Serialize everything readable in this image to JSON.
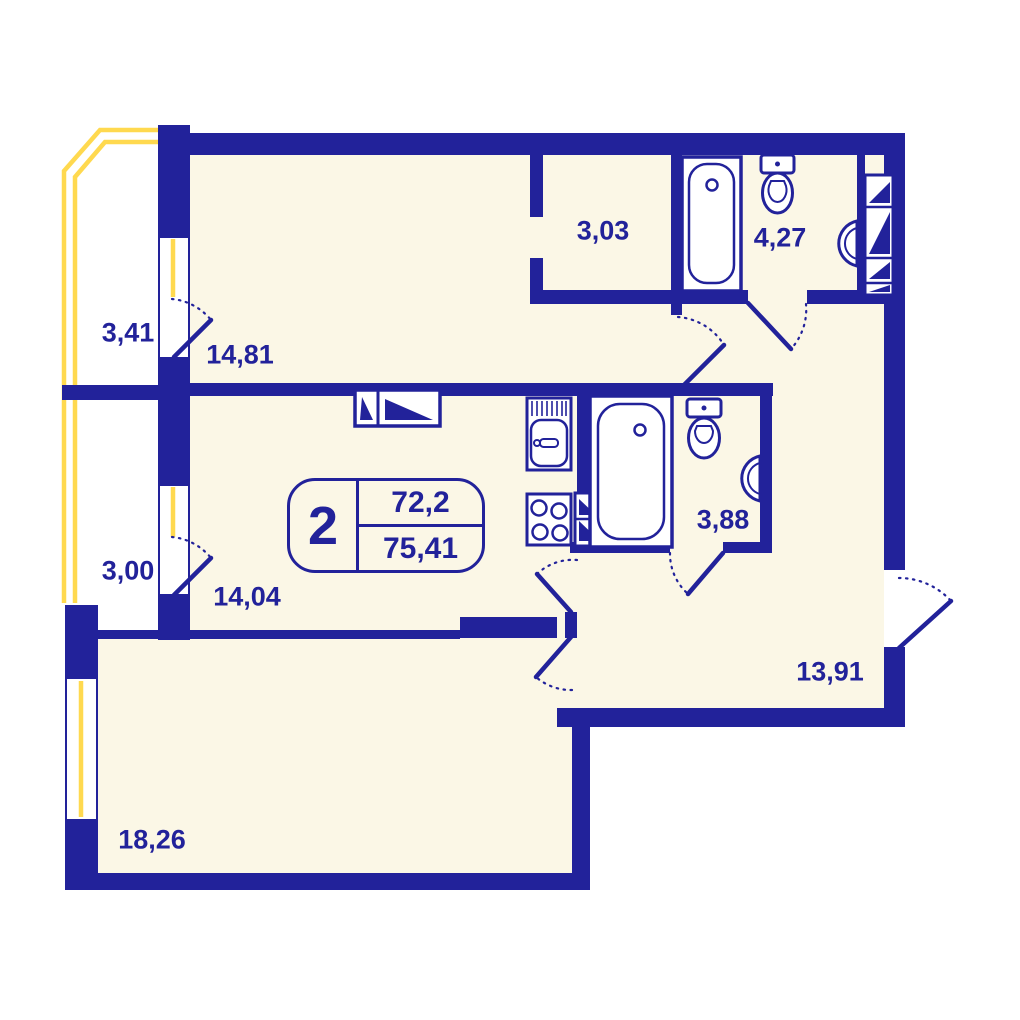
{
  "plan": {
    "summary": {
      "rooms_count": "2",
      "area_main": "72,2",
      "area_total": "75,41"
    },
    "rooms": [
      {
        "id": "balcony-upper",
        "area": "3,41"
      },
      {
        "id": "bedroom",
        "area": "14,81"
      },
      {
        "id": "wardrobe",
        "area": "3,03"
      },
      {
        "id": "bathroom-main",
        "area": "4,27"
      },
      {
        "id": "balcony-lower",
        "area": "3,00"
      },
      {
        "id": "kitchen-living",
        "area": "14,04"
      },
      {
        "id": "bathroom-second",
        "area": "3,88"
      },
      {
        "id": "hallway",
        "area": "13,91"
      },
      {
        "id": "living-room",
        "area": "18,26"
      }
    ],
    "colors": {
      "wall": "#22229a",
      "floor": "#fbf7e6",
      "glazing": "#ffd94f",
      "background": "#ffffff"
    }
  }
}
